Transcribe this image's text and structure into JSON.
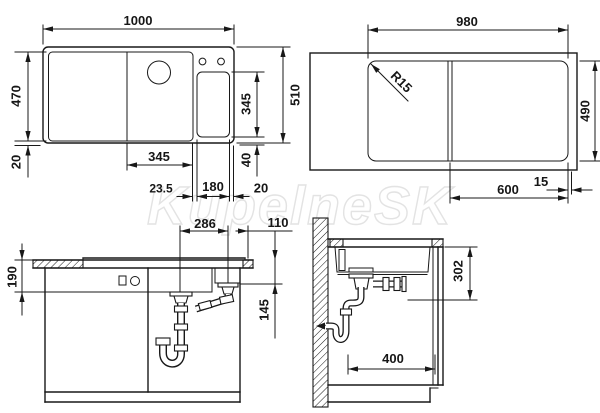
{
  "watermark": "KupelneSK",
  "top_view": {
    "overall_width": "1000",
    "overall_depth": "510",
    "inner_depth": "470",
    "edge_gap_left": "20",
    "bowl_depth": "345",
    "bottom_gap": "40",
    "bowl_width": "345",
    "divider_offset": "23.5",
    "half_bowl_width": "180",
    "edge_gap_right": "20"
  },
  "cutout_view": {
    "cutout_width": "980",
    "cutout_depth": "490",
    "corner_radius": "R15",
    "bowl_center_offset": "600",
    "edge_offset": "15"
  },
  "front_view": {
    "drain_spacing": "286",
    "drain_to_edge": "110",
    "apron_height": "190",
    "drain_depth": "145"
  },
  "side_view": {
    "under_counter_depth": "302",
    "trap_to_front": "400"
  }
}
